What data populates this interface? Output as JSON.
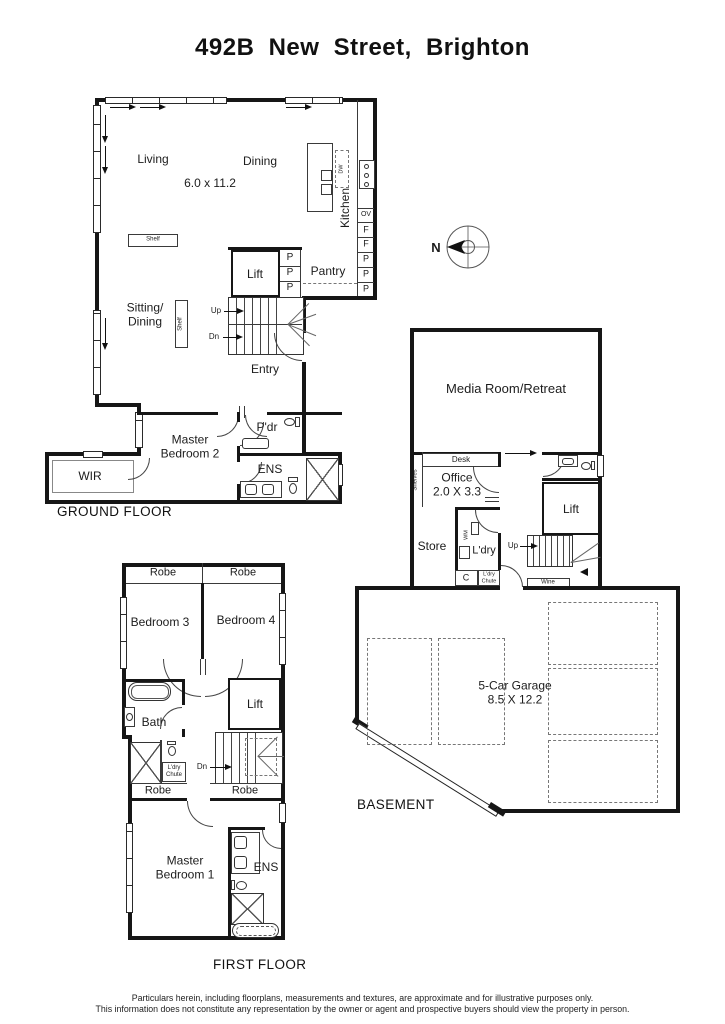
{
  "title": "492B New Street, Brighton",
  "compass": {
    "n": "N"
  },
  "gf": {
    "caption": "GROUND FLOOR",
    "living": "Living",
    "dining": "Dining",
    "dims": "6.0 x 11.2",
    "sitting": "Sitting/\nDining",
    "kitchen": "Kitchen",
    "dw": "DW",
    "shelf1": "Shelf",
    "shelf2": "Shelf",
    "lift": "Lift",
    "pantry": "Pantry",
    "up": "Up",
    "dn": "Dn",
    "entry": "Entry",
    "pdr": "P'dr",
    "ens": "ENS",
    "master2": "Master\nBedroom 2",
    "wir": "WIR",
    "appliances": [
      "OV",
      "F",
      "F",
      "P",
      "P",
      "P"
    ],
    "pcol": [
      "P",
      "P",
      "P"
    ]
  },
  "ff": {
    "caption": "FIRST FLOOR",
    "robe1": "Robe",
    "robe2": "Robe",
    "bed3": "Bedroom 3",
    "bed4": "Bedroom 4",
    "bath": "Bath",
    "lift": "Lift",
    "dn": "Dn",
    "chute": "L'dry\nChute",
    "robe3": "Robe",
    "robe4": "Robe",
    "master1": "Master\nBedroom 1",
    "ens": "ENS"
  },
  "bm": {
    "caption": "BASEMENT",
    "media": "Media Room/Retreat",
    "desk": "Desk",
    "office": "Office\n2.0 X 3.3",
    "shelves": "Shelves",
    "store": "Store",
    "ldry": "L'dry",
    "wm": "WM",
    "c": "C",
    "chute": "L'dry\nChute",
    "lift": "Lift",
    "up": "Up",
    "wine": "Wine",
    "garage": "5-Car Garage\n8.5 X 12.2"
  },
  "disclaimer": {
    "line1": "Particulars herein, including floorplans, measurements and textures, are approximate and for illustrative purposes only.",
    "line2": "This information does not constitute any representation by the owner or agent and prospective buyers should view the property in person."
  }
}
